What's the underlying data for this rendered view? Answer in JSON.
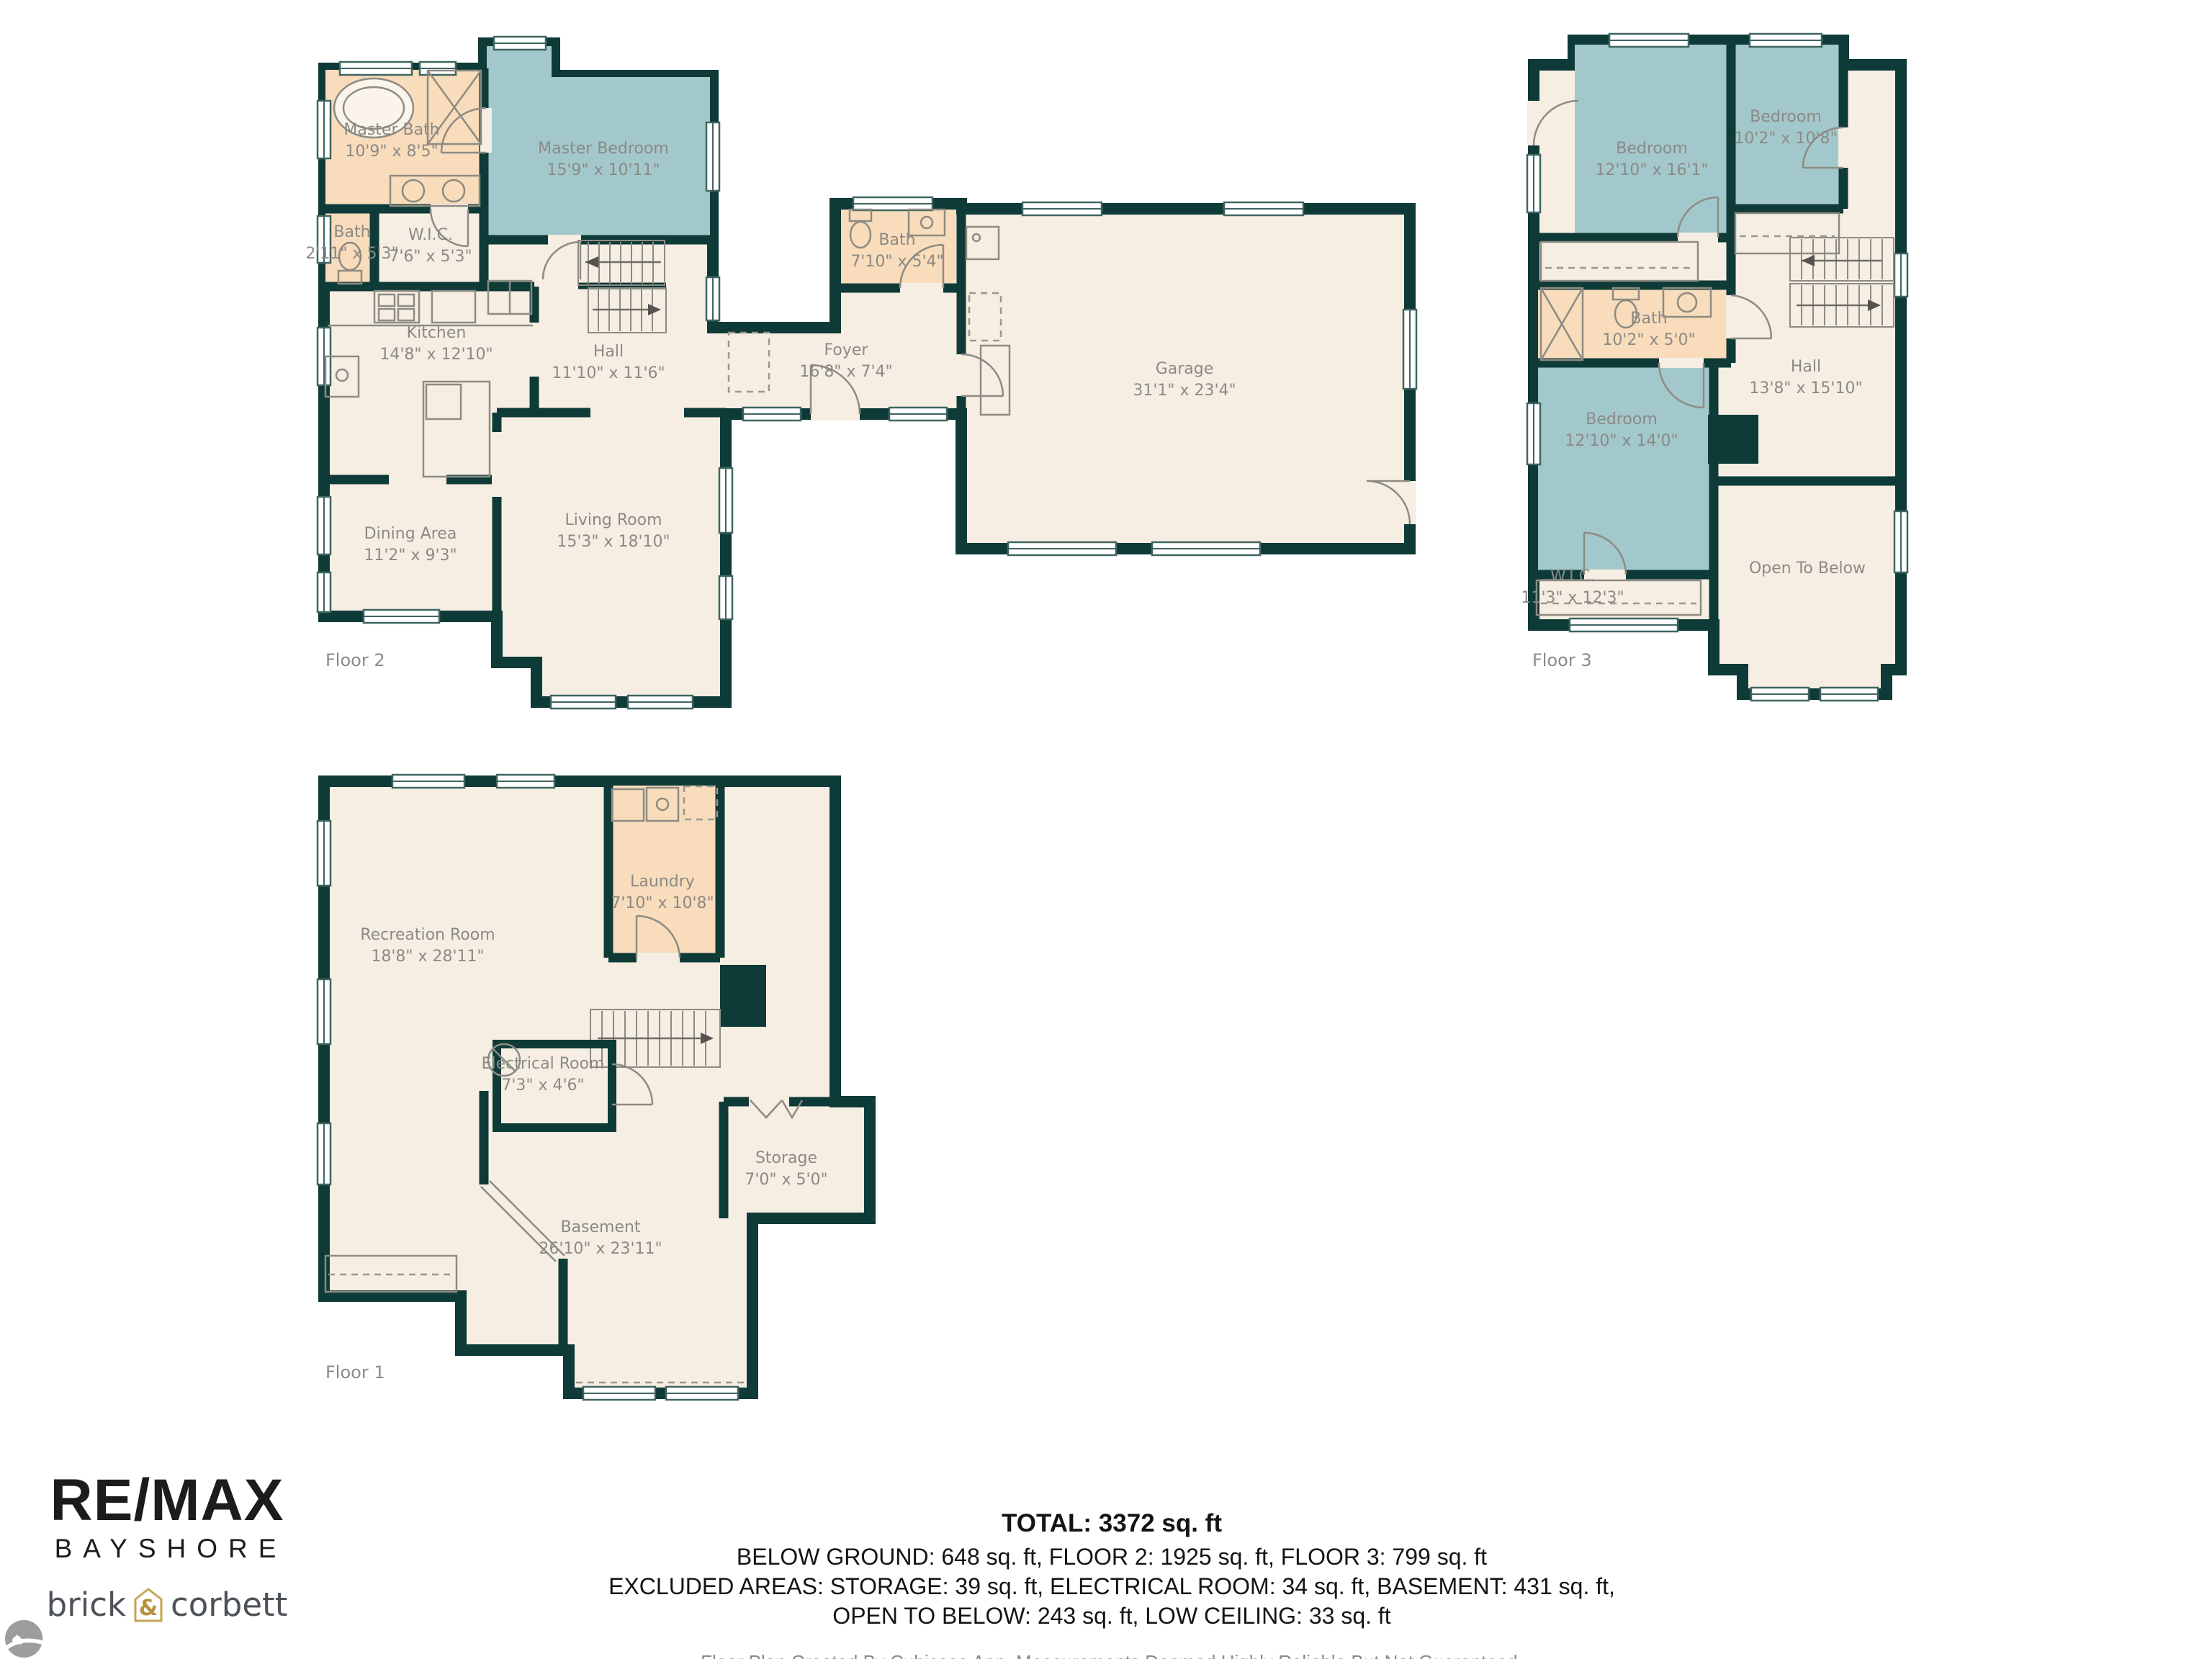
{
  "floors": {
    "floor2": {
      "label": "Floor 2",
      "rooms": {
        "master_bath": {
          "name": "Master Bath",
          "dims": "10'9\" x 8'5\""
        },
        "master_bedroom": {
          "name": "Master Bedroom",
          "dims": "15'9\" x 10'11\""
        },
        "bath_small": {
          "name": "Bath",
          "dims": "2'11\" x 5'3\""
        },
        "wic": {
          "name": "W.I.C.",
          "dims": "7'6\" x 5'3\""
        },
        "kitchen": {
          "name": "Kitchen",
          "dims": "14'8\" x 12'10\""
        },
        "hall": {
          "name": "Hall",
          "dims": "11'10\" x 11'6\""
        },
        "dining": {
          "name": "Dining Area",
          "dims": "11'2\" x 9'3\""
        },
        "living": {
          "name": "Living Room",
          "dims": "15'3\" x 18'10\""
        },
        "foyer": {
          "name": "Foyer",
          "dims": "16'8\" x 7'4\""
        },
        "bath_garage": {
          "name": "Bath",
          "dims": "7'10\" x 5'4\""
        },
        "garage": {
          "name": "Garage",
          "dims": "31'1\" x 23'4\""
        }
      }
    },
    "floor3": {
      "label": "Floor 3",
      "rooms": {
        "bedroom_large": {
          "name": "Bedroom",
          "dims": "12'10\" x 16'1\""
        },
        "bedroom_small": {
          "name": "Bedroom",
          "dims": "10'2\" x 10'8\""
        },
        "bath": {
          "name": "Bath",
          "dims": "10'2\" x 5'0\""
        },
        "hall": {
          "name": "Hall",
          "dims": "13'8\" x 15'10\""
        },
        "bedroom_lower": {
          "name": "Bedroom",
          "dims": "12'10\" x 14'0\""
        },
        "wic": {
          "name": "W.I.C.",
          "dims": "11'3\" x 12'3\""
        },
        "open_below": {
          "name": "Open To Below",
          "dims": ""
        }
      }
    },
    "floor1": {
      "label": "Floor 1",
      "rooms": {
        "recreation": {
          "name": "Recreation Room",
          "dims": "18'8\" x 28'11\""
        },
        "laundry": {
          "name": "Laundry",
          "dims": "7'10\" x 10'8\""
        },
        "electrical": {
          "name": "Electrical Room",
          "dims": "7'3\" x 4'6\""
        },
        "storage": {
          "name": "Storage",
          "dims": "7'0\" x 5'0\""
        },
        "basement": {
          "name": "Basement",
          "dims": "26'10\" x 23'11\""
        }
      }
    }
  },
  "summary": {
    "total": "TOTAL: 3372 sq. ft",
    "below_ground_line": "BELOW GROUND: 648 sq. ft, FLOOR 2: 1925 sq. ft, FLOOR 3: 799 sq. ft",
    "excluded_line1": "EXCLUDED AREAS: STORAGE: 39 sq. ft, ELECTRICAL ROOM: 34 sq. ft, BASEMENT: 431 sq. ft,",
    "excluded_line2": "OPEN TO BELOW: 243 sq. ft, LOW CEILING: 33 sq. ft",
    "disclaimer": "Floor Plan Created By Cubicasa App. Measurements Deemed Highly Reliable But Not Guaranteed."
  },
  "branding": {
    "remax": "RE/MAX",
    "bayshore": "BAYSHORE",
    "brick": "brick",
    "amp": "&",
    "corbett": "corbett"
  },
  "colors": {
    "wall": "#0e3a37",
    "room_cream": "#f6eee3",
    "room_peach": "#f8dcbb",
    "room_teal": "#a3c8cb",
    "label_gray": "#8b8a86",
    "brand_black": "#1c1c1a",
    "brand_gold": "#c3a553",
    "agency_gray": "#4c5257"
  }
}
